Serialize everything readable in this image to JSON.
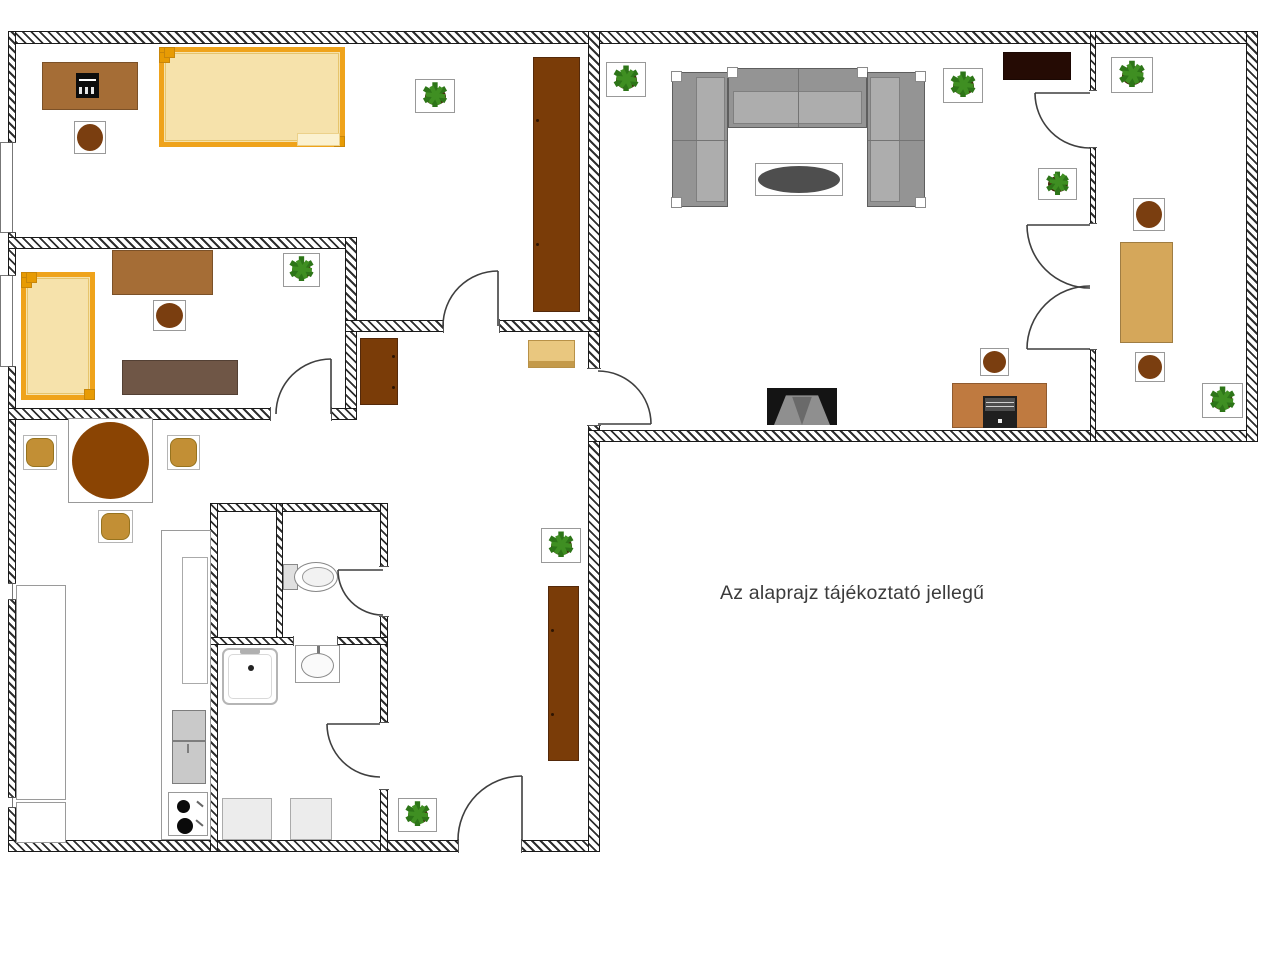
{
  "note": {
    "text": "Az alaprajz tájékoztató jellegű"
  },
  "canvas": {
    "width": 1280,
    "height": 955,
    "background": "#ffffff"
  },
  "icons": {
    "plant-icon": "✱",
    "stove-burner-icon": "●",
    "toilet-icon": "ellipse-shape",
    "washbasin-icon": "ellipse-shape",
    "shower-icon": "rounded-square-shape",
    "door-swing-icon": "quarter-arc"
  },
  "palette": {
    "wall_line": "#1a1a1a",
    "door_line": "#3f3f3f",
    "bed_frame": "#efa31b",
    "bed_fill": "#f6e2ab",
    "desk_brown": "#a56d36",
    "wardrobe_brown": "#7a3c08",
    "stool_brown": "#7a3e10",
    "dresser_gray": "#6f5646",
    "dresser_tan": "#e9c77f",
    "dresser_tan_edge": "#c49a4a",
    "desk_tan": "#d5a75a",
    "chair_tan": "#c28f35",
    "table_brown": "#8a4403",
    "sofa_base": "#949494",
    "sofa_seat": "#adadad",
    "sofa_line": "#5e5e5e",
    "coffee_table": "#4e4e4e",
    "tv_stand": "#250b04",
    "tv_body": "#141414",
    "tv_screen": "#8f8f8f",
    "tv_screen_dark": "#6a6a6a",
    "computer_desk": "#bf7a40",
    "plant_green": "#2d7518",
    "plant_green2": "#3f8f22",
    "plant_pot": "#45220a",
    "appliance": "#c9c9c9",
    "light_gray": "#ececec",
    "white": "#ffffff",
    "text": "#3b3b3b"
  },
  "walls": [
    {
      "name": "wall-top",
      "x": 9,
      "y": 31,
      "w": 1249,
      "h": 13
    },
    {
      "name": "wall-left",
      "x": 8,
      "y": 31,
      "w": 8,
      "h": 821
    },
    {
      "name": "wall-bottom-left",
      "x": 8,
      "y": 840,
      "w": 592,
      "h": 12
    },
    {
      "name": "wall-center-vertical",
      "x": 588,
      "y": 31,
      "w": 12,
      "h": 821
    },
    {
      "name": "wall-bottom-right",
      "x": 588,
      "y": 430,
      "w": 670,
      "h": 12
    },
    {
      "name": "wall-right",
      "x": 1246,
      "y": 31,
      "w": 12,
      "h": 411
    },
    {
      "name": "wall-living-rightroom",
      "x": 1090,
      "y": 31,
      "w": 6,
      "h": 411
    },
    {
      "name": "wall-bedroom2-top",
      "x": 8,
      "y": 237,
      "w": 349,
      "h": 12
    },
    {
      "name": "wall-bedroom2-right",
      "x": 345,
      "y": 237,
      "w": 12,
      "h": 183
    },
    {
      "name": "wall-bedroom2-bottom",
      "x": 8,
      "y": 408,
      "w": 349,
      "h": 12
    },
    {
      "name": "wall-bedroom1-bottom",
      "x": 345,
      "y": 320,
      "w": 255,
      "h": 12
    },
    {
      "name": "wall-bath-top",
      "x": 210,
      "y": 503,
      "w": 178,
      "h": 9
    },
    {
      "name": "wall-bath-left",
      "x": 210,
      "y": 503,
      "w": 8,
      "h": 349
    },
    {
      "name": "wall-bath-right",
      "x": 380,
      "y": 503,
      "w": 8,
      "h": 349
    },
    {
      "name": "wall-bath-inner-vertical",
      "x": 276,
      "y": 503,
      "w": 7,
      "h": 142
    },
    {
      "name": "wall-bath-inner-horizontal",
      "x": 210,
      "y": 637,
      "w": 178,
      "h": 8
    }
  ],
  "openings": [
    {
      "name": "opening-bedroom1-door",
      "x": 443,
      "y": 319,
      "w": 57,
      "h": 14,
      "o": "h"
    },
    {
      "name": "opening-bedroom2-door",
      "x": 270,
      "y": 407,
      "w": 62,
      "h": 14,
      "o": "h"
    },
    {
      "name": "opening-hall-living-door",
      "x": 587,
      "y": 368,
      "w": 14,
      "h": 58,
      "o": "v"
    },
    {
      "name": "opening-living-rightroom-door",
      "x": 1089,
      "y": 90,
      "w": 8,
      "h": 58,
      "o": "v"
    },
    {
      "name": "opening-living-rightroom-double",
      "x": 1089,
      "y": 223,
      "w": 8,
      "h": 127,
      "o": "v"
    },
    {
      "name": "opening-wc-door",
      "x": 379,
      "y": 566,
      "w": 10,
      "h": 51,
      "o": "v"
    },
    {
      "name": "opening-bathroom-door",
      "x": 379,
      "y": 722,
      "w": 10,
      "h": 68,
      "o": "v"
    },
    {
      "name": "opening-entrance-door",
      "x": 458,
      "y": 839,
      "w": 64,
      "h": 14,
      "o": "h"
    },
    {
      "name": "opening-bath-divider",
      "x": 293,
      "y": 636,
      "w": 45,
      "h": 10,
      "o": "h"
    }
  ],
  "windows": [
    {
      "name": "window-bedroom1",
      "x": 8,
      "y": 142,
      "w": 8,
      "h": 91
    },
    {
      "name": "window-bedroom2",
      "x": 8,
      "y": 275,
      "w": 8,
      "h": 92
    },
    {
      "name": "window-kitchen-a",
      "x": 8,
      "y": 583,
      "w": 8,
      "h": 17
    },
    {
      "name": "window-kitchen-b",
      "x": 8,
      "y": 797,
      "w": 8,
      "h": 11
    }
  ],
  "window_sills": [
    {
      "name": "sill-bedroom1",
      "x": 0,
      "y": 142,
      "w": 9,
      "h": 91
    },
    {
      "name": "sill-bedroom2",
      "x": 0,
      "y": 275,
      "w": 9,
      "h": 92
    }
  ],
  "doors": [
    {
      "name": "door-bedroom1",
      "hx": 498,
      "hy": 326,
      "r": 55,
      "a1": "n",
      "a2": "w"
    },
    {
      "name": "door-bedroom2",
      "hx": 331,
      "hy": 414,
      "r": 55,
      "a1": "n",
      "a2": "w"
    },
    {
      "name": "door-hall-living",
      "hx": 598,
      "hy": 424,
      "r": 53,
      "a1": "e",
      "a2": "n"
    },
    {
      "name": "door-living-rightroom",
      "hx": 1090,
      "hy": 93,
      "r": 55,
      "a1": "w",
      "a2": "s"
    },
    {
      "name": "door-double-top",
      "hx": 1090,
      "hy": 225,
      "r": 63,
      "a1": "w",
      "a2": "s"
    },
    {
      "name": "door-double-bottom",
      "hx": 1090,
      "hy": 349,
      "r": 63,
      "a1": "w",
      "a2": "n"
    },
    {
      "name": "door-wc",
      "hx": 383,
      "hy": 570,
      "r": 45,
      "a1": "w",
      "a2": "s"
    },
    {
      "name": "door-bathroom",
      "hx": 380,
      "hy": 724,
      "r": 53,
      "a1": "w",
      "a2": "s"
    },
    {
      "name": "door-entrance",
      "hx": 522,
      "hy": 840,
      "r": 64,
      "a1": "n",
      "a2": "w"
    }
  ],
  "furniture": [
    {
      "name": "bedroom1-desk",
      "kind": "rect",
      "x": 42,
      "y": 62,
      "w": 96,
      "h": 48,
      "fill": "desk_brown"
    },
    {
      "name": "bedroom1-printer",
      "kind": "printer",
      "x": 76,
      "y": 73,
      "w": 23,
      "h": 25
    },
    {
      "name": "bedroom1-stool",
      "kind": "boxed-circle",
      "x": 74,
      "y": 121,
      "w": 32,
      "h": 33,
      "fill": "stool_brown"
    },
    {
      "name": "bedroom1-double-bed",
      "kind": "bed",
      "x": 159,
      "y": 47,
      "w": 186,
      "h": 100,
      "strip": true
    },
    {
      "name": "bedroom1-wardrobe",
      "kind": "wardrobe",
      "x": 533,
      "y": 57,
      "w": 47,
      "h": 255,
      "handles": "left"
    },
    {
      "name": "bedroom1-plant",
      "kind": "plant",
      "x": 415,
      "y": 79,
      "w": 40,
      "h": 34
    },
    {
      "name": "bedroom2-bed",
      "kind": "bed",
      "x": 21,
      "y": 272,
      "w": 74,
      "h": 128
    },
    {
      "name": "bedroom2-desk",
      "kind": "rect",
      "x": 112,
      "y": 250,
      "w": 101,
      "h": 45,
      "fill": "desk_brown"
    },
    {
      "name": "bedroom2-stool",
      "kind": "boxed-circle",
      "x": 153,
      "y": 300,
      "w": 33,
      "h": 31,
      "fill": "stool_brown"
    },
    {
      "name": "bedroom2-dresser",
      "kind": "rect",
      "x": 122,
      "y": 360,
      "w": 116,
      "h": 35,
      "fill": "dresser_gray"
    },
    {
      "name": "bedroom2-plant",
      "kind": "plant",
      "x": 283,
      "y": 253,
      "w": 37,
      "h": 34
    },
    {
      "name": "hall-wardrobe-small",
      "kind": "wardrobe",
      "x": 360,
      "y": 338,
      "w": 38,
      "h": 67,
      "handles": "right"
    },
    {
      "name": "hall-dresser",
      "kind": "dresser-tan",
      "x": 528,
      "y": 340,
      "w": 47,
      "h": 28
    },
    {
      "name": "living-plant-left",
      "kind": "plant",
      "x": 606,
      "y": 62,
      "w": 40,
      "h": 35
    },
    {
      "name": "living-plant-right",
      "kind": "plant",
      "x": 943,
      "y": 68,
      "w": 40,
      "h": 35
    },
    {
      "name": "sofa-left-section",
      "kind": "sofa",
      "x": 672,
      "y": 72,
      "w": 56,
      "h": 135,
      "inner": "right",
      "corners": [
        "tl",
        "bl"
      ]
    },
    {
      "name": "sofa-top-section",
      "kind": "sofa",
      "x": 728,
      "y": 68,
      "w": 139,
      "h": 60,
      "inner": "bottom",
      "corners": [
        "tl",
        "tr"
      ]
    },
    {
      "name": "sofa-right-section",
      "kind": "sofa",
      "x": 867,
      "y": 72,
      "w": 58,
      "h": 135,
      "inner": "left",
      "corners": [
        "tr",
        "br"
      ]
    },
    {
      "name": "coffee-table",
      "kind": "boxed-ellipse",
      "x": 755,
      "y": 163,
      "w": 88,
      "h": 33,
      "fill": "coffee_table"
    },
    {
      "name": "tv-cabinet",
      "kind": "rect",
      "x": 1003,
      "y": 52,
      "w": 68,
      "h": 28,
      "fill": "tv_stand"
    },
    {
      "name": "tv",
      "kind": "tv",
      "x": 767,
      "y": 388,
      "w": 70,
      "h": 37
    },
    {
      "name": "computer-desk",
      "kind": "rect",
      "x": 952,
      "y": 383,
      "w": 95,
      "h": 45,
      "fill": "computer_desk"
    },
    {
      "name": "desktop-computer",
      "kind": "computer",
      "x": 983,
      "y": 396,
      "w": 34,
      "h": 32
    },
    {
      "name": "computer-desk-stool",
      "kind": "boxed-circle",
      "x": 980,
      "y": 348,
      "w": 29,
      "h": 28,
      "fill": "stool_brown"
    },
    {
      "name": "living-plant-doorside",
      "kind": "plant",
      "x": 1038,
      "y": 168,
      "w": 39,
      "h": 32
    },
    {
      "name": "rightroom-plant-top",
      "kind": "plant",
      "x": 1111,
      "y": 57,
      "w": 42,
      "h": 36
    },
    {
      "name": "rightroom-stool-top",
      "kind": "boxed-circle",
      "x": 1133,
      "y": 198,
      "w": 32,
      "h": 33,
      "fill": "stool_brown"
    },
    {
      "name": "rightroom-desk",
      "kind": "rect",
      "x": 1120,
      "y": 242,
      "w": 53,
      "h": 101,
      "fill": "desk_tan"
    },
    {
      "name": "rightroom-stool-bottom",
      "kind": "boxed-circle",
      "x": 1135,
      "y": 352,
      "w": 30,
      "h": 30,
      "fill": "stool_brown"
    },
    {
      "name": "rightroom-plant-bottom",
      "kind": "plant",
      "x": 1202,
      "y": 383,
      "w": 41,
      "h": 35
    },
    {
      "name": "dining-table",
      "kind": "boxed-circle",
      "x": 68,
      "y": 418,
      "w": 85,
      "h": 85,
      "fill": "table_brown",
      "inset": 3
    },
    {
      "name": "dining-chair-left",
      "kind": "chair",
      "x": 23,
      "y": 435,
      "w": 34,
      "h": 35
    },
    {
      "name": "dining-chair-right",
      "kind": "chair",
      "x": 167,
      "y": 435,
      "w": 33,
      "h": 35
    },
    {
      "name": "dining-chair-bottom",
      "kind": "chair",
      "x": 98,
      "y": 510,
      "w": 35,
      "h": 33
    },
    {
      "name": "hall-plant-upper",
      "kind": "plant",
      "x": 541,
      "y": 528,
      "w": 40,
      "h": 35
    },
    {
      "name": "hall-wardrobe-tall",
      "kind": "wardrobe",
      "x": 548,
      "y": 586,
      "w": 31,
      "h": 175,
      "handles": "left"
    },
    {
      "name": "entrance-plant",
      "kind": "plant",
      "x": 398,
      "y": 798,
      "w": 39,
      "h": 34
    },
    {
      "name": "kitchen-cabinet-column",
      "kind": "rect",
      "x": 161,
      "y": 530,
      "w": 50,
      "h": 310,
      "fill": "white",
      "stroke": "#9a9a9a"
    },
    {
      "name": "kitchen-counter-inner",
      "kind": "rect",
      "x": 182,
      "y": 557,
      "w": 26,
      "h": 127,
      "fill": "white",
      "stroke": "#aaaaaa"
    },
    {
      "name": "fridge",
      "kind": "fridge",
      "x": 172,
      "y": 710,
      "w": 34,
      "h": 74
    },
    {
      "name": "stove",
      "kind": "stove",
      "x": 168,
      "y": 792,
      "w": 40,
      "h": 44
    },
    {
      "name": "kitchen-counter-left",
      "kind": "rect",
      "x": 16,
      "y": 585,
      "w": 50,
      "h": 215,
      "fill": "white",
      "stroke": "#9a9a9a"
    },
    {
      "name": "kitchen-counter-left-lower",
      "kind": "rect",
      "x": 16,
      "y": 802,
      "w": 50,
      "h": 41,
      "fill": "white",
      "stroke": "#9a9a9a"
    },
    {
      "name": "toilet",
      "kind": "toilet",
      "x": 283,
      "y": 562,
      "w": 55,
      "h": 30
    },
    {
      "name": "shower-tray",
      "kind": "shower",
      "x": 222,
      "y": 648,
      "w": 56,
      "h": 57
    },
    {
      "name": "washbasin",
      "kind": "sink",
      "x": 295,
      "y": 645,
      "w": 45,
      "h": 38
    },
    {
      "name": "washing-machine",
      "kind": "rect",
      "x": 222,
      "y": 798,
      "w": 50,
      "h": 42,
      "fill": "light_gray",
      "stroke": "#aaaaaa"
    },
    {
      "name": "bath-cabinet",
      "kind": "rect",
      "x": 290,
      "y": 798,
      "w": 42,
      "h": 42,
      "fill": "light_gray",
      "stroke": "#aaaaaa"
    }
  ]
}
